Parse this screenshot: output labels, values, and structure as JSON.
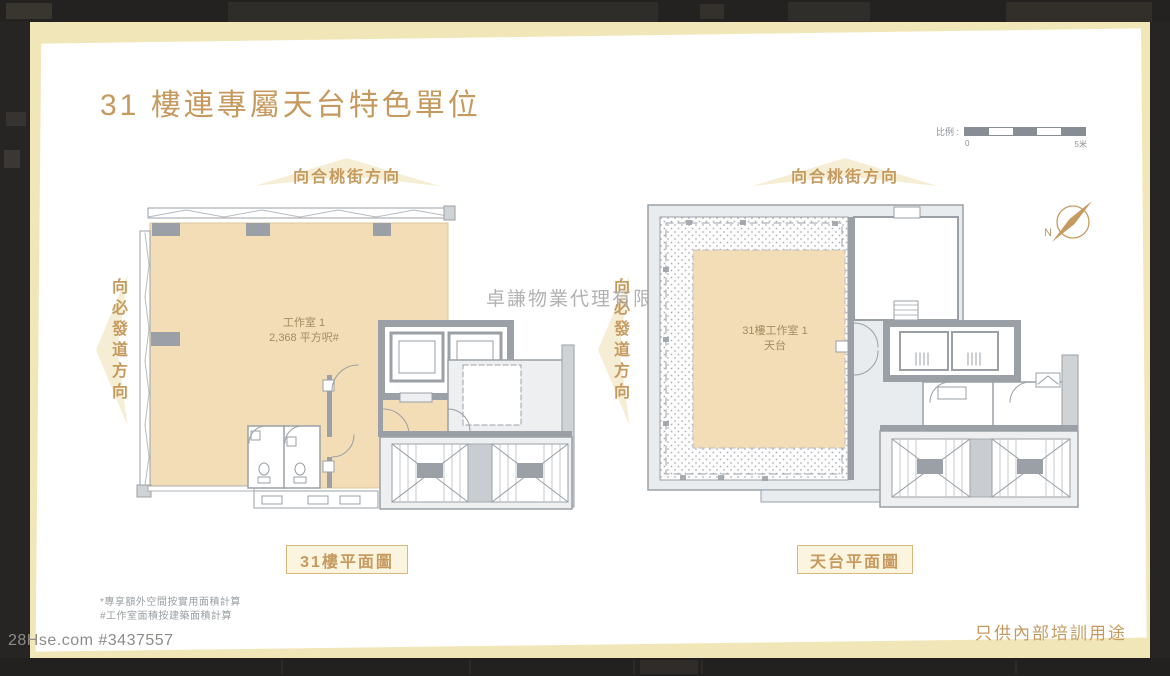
{
  "viewer": {
    "listing_id": "28Hse.com #3437557"
  },
  "page": {
    "title": "31 樓連專屬天台特色單位",
    "watermark": "卓謙物業代理有限公司",
    "disclaimer": "只供內部培訓用途",
    "footnote_1": "*專享額外空間按實用面積計算",
    "footnote_2": "#工作室面積按建築面積計算",
    "scale_bar": {
      "label": "比例 :",
      "min": "0",
      "max": "5米"
    },
    "compass_n": "N"
  },
  "plan_left": {
    "direction_top": "向合桃街方向",
    "direction_side": "向必發道方向",
    "room_line1": "工作室 1",
    "room_line2": "2,368 平方呎#",
    "caption": "31樓平面圖"
  },
  "plan_right": {
    "direction_top": "向合桃街方向",
    "direction_side": "向必發道方向",
    "room_line1": "31樓工作室 1",
    "room_line2": "天台",
    "caption": "天台平面圖"
  },
  "colors": {
    "accent_gold": "#c69a5f",
    "plan_fill_tan": "#f2ddb6",
    "wall_gray": "#9aa0a5",
    "slide_cream": "#f1e6b8",
    "viewer_background": "#272523"
  }
}
